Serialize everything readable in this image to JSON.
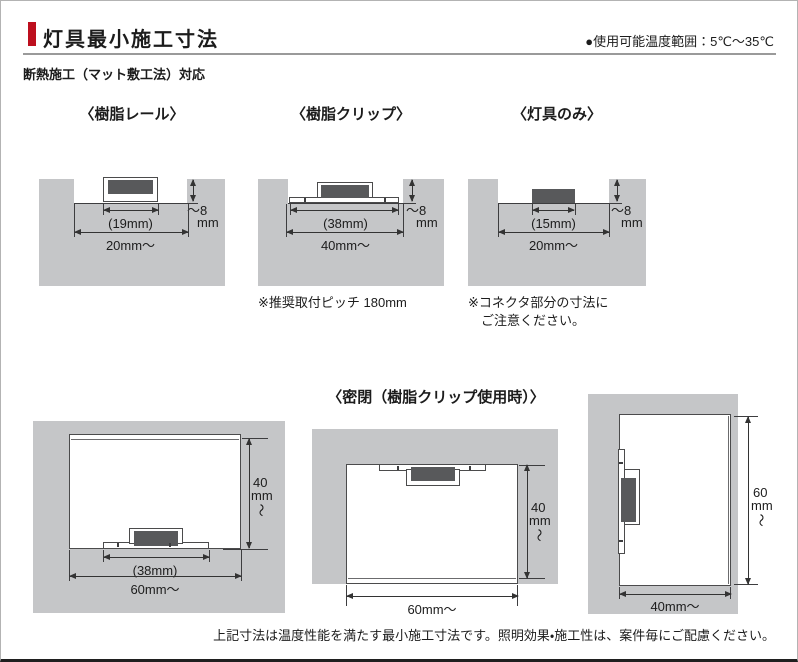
{
  "header": {
    "title": "灯具最小施工寸法",
    "temp_range": "●使用可能温度範囲：5℃～35℃",
    "subtitle": "断熱施工（マット敷工法）対応"
  },
  "colors": {
    "accent_red": "#bd0f1e",
    "insulation_gray": "#c5c6c8",
    "fixture_dark": "#58595b"
  },
  "top_diagrams": [
    {
      "title": "〈樹脂レール〉",
      "inner_dim": "(19mm)",
      "outer_dim": "20mm～",
      "depth_value": "～8",
      "depth_unit": "mm",
      "note_lines": []
    },
    {
      "title": "〈樹脂クリップ〉",
      "inner_dim": "(38mm)",
      "outer_dim": "40mm～",
      "depth_value": "～8",
      "depth_unit": "mm",
      "note_lines": [
        "※推奨取付ピッチ 180mm"
      ]
    },
    {
      "title": "〈灯具のみ〉",
      "inner_dim": "(15mm)",
      "outer_dim": "20mm～",
      "depth_value": "～8",
      "depth_unit": "mm",
      "note_lines": [
        "※コネクタ部分の寸法に",
        "ご注意ください。"
      ]
    }
  ],
  "bottom": {
    "title": "〈密閉（樹脂クリップ使用時）〉",
    "diagrams": [
      {
        "inner_dim": "(38mm)",
        "width_dim": "60mm～",
        "height_value": "40",
        "height_unit": "mm",
        "height_tilde": "～"
      },
      {
        "width_dim": "60mm～",
        "height_value": "40",
        "height_unit": "mm",
        "height_tilde": "～"
      },
      {
        "width_dim": "40mm～",
        "height_value": "60",
        "height_unit": "mm",
        "height_tilde": "～"
      }
    ]
  },
  "footer": {
    "note": "上記寸法は温度性能を満たす最小施工寸法です。照明効果・施工性は、案件毎にご配慮ください。"
  }
}
